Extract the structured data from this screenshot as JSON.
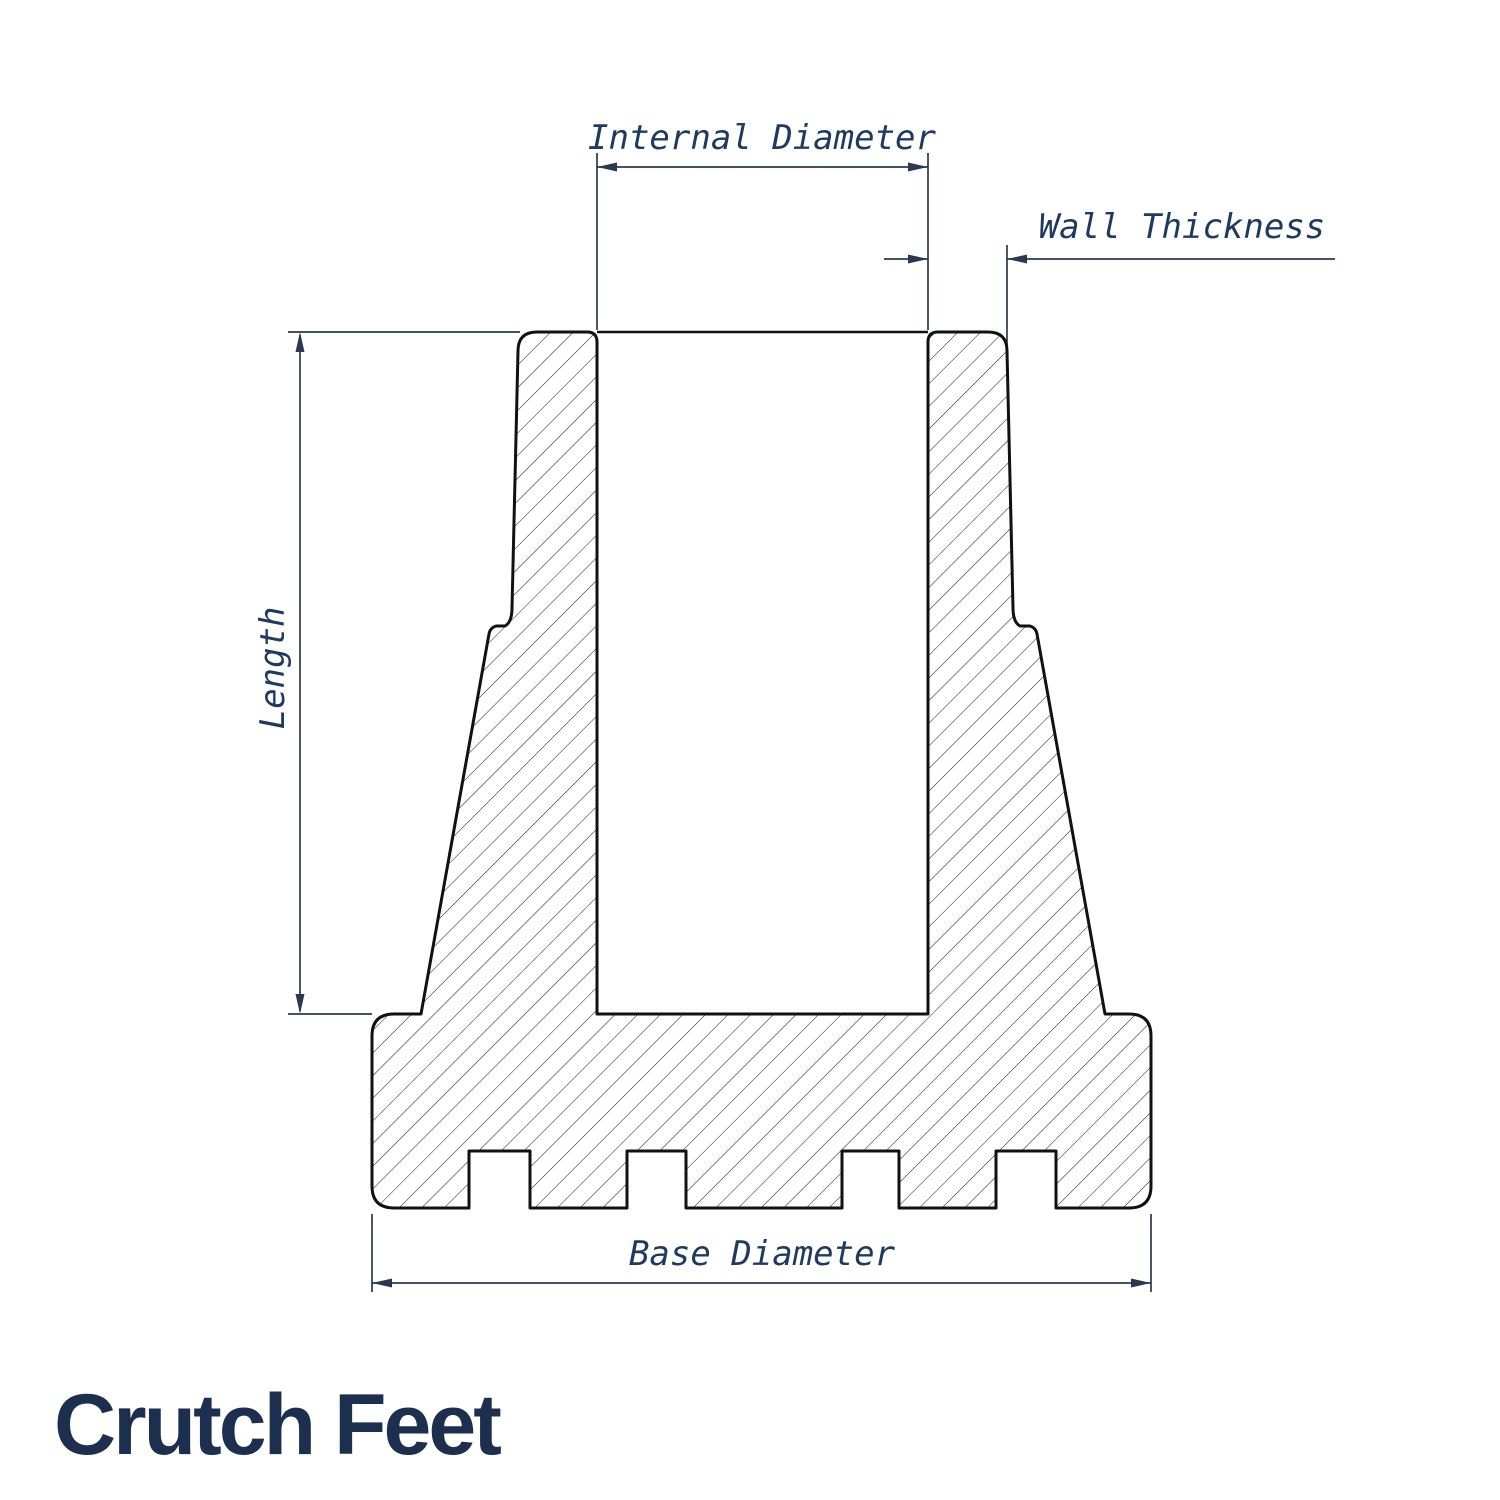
{
  "title": "Crutch Feet",
  "drawing": {
    "subject": "crutch foot cross-section",
    "dimensions": {
      "internal_diameter": {
        "label": "Internal Diameter"
      },
      "wall_thickness": {
        "label": "Wall Thickness"
      },
      "length": {
        "label": "Length"
      },
      "base_diameter": {
        "label": "Base Diameter"
      }
    }
  },
  "colors": {
    "outline": "#111111",
    "hatch": "#1a1a1a",
    "dimension": "#2a3950",
    "label": "#1e3a5f",
    "title": "#1d2f4e",
    "background": "#ffffff"
  }
}
